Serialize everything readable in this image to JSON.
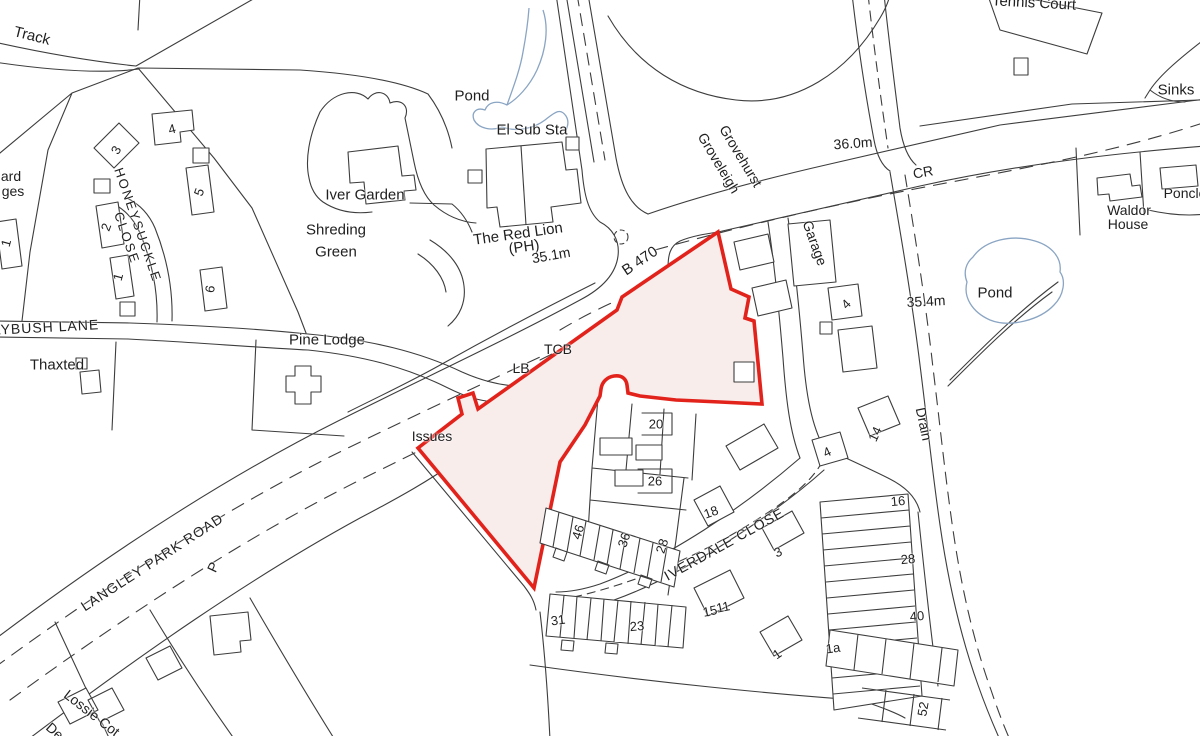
{
  "colors": {
    "background": "#ffffff",
    "linework": "#3d3d3d",
    "water": "#8aa5c3",
    "site_boundary": "#e2231c",
    "site_fill": "#f9edec",
    "label_text": "#1f1f1f"
  },
  "map": {
    "site": {
      "boundary_color_name": "red",
      "status_label": "Issues"
    },
    "road_names": [
      "LANGLEY PARK ROAD",
      "B 470",
      "LYBUSH LANE",
      "HONEYSUCKLE CLOSE",
      "IVERDALE CLOSE"
    ],
    "spot_heights": [
      "35.1m",
      "36.0m",
      "35.4m"
    ],
    "labels": [
      {
        "text": "Track",
        "x": 32,
        "y": 36,
        "r": 14,
        "s": 15
      },
      {
        "text": "4",
        "x": 172,
        "y": 129,
        "r": -15,
        "s": 13
      },
      {
        "text": "3",
        "x": 116,
        "y": 150,
        "r": -60,
        "s": 13
      },
      {
        "text": "5",
        "x": 199,
        "y": 192,
        "r": -70,
        "s": 13
      },
      {
        "text": "ard",
        "x": 11,
        "y": 176,
        "r": 0,
        "s": 14
      },
      {
        "text": "ges",
        "x": 13,
        "y": 191,
        "r": 0,
        "s": 14
      },
      {
        "text": "HONEYSUCKLE",
        "x": 138,
        "y": 225,
        "r": 71,
        "s": 13,
        "ls": 2
      },
      {
        "text": "CLOSE",
        "x": 127,
        "y": 238,
        "r": 71,
        "s": 13,
        "ls": 2
      },
      {
        "text": "2",
        "x": 106,
        "y": 227,
        "r": -70,
        "s": 13
      },
      {
        "text": "1",
        "x": 6,
        "y": 243,
        "r": -75,
        "s": 13
      },
      {
        "text": "1",
        "x": 118,
        "y": 277,
        "r": -75,
        "s": 13
      },
      {
        "text": "6",
        "x": 210,
        "y": 289,
        "r": -80,
        "s": 13
      },
      {
        "text": "LYBUSH LANE",
        "x": 46,
        "y": 327,
        "r": -3,
        "s": 14,
        "ls": 1
      },
      {
        "text": "Thaxted",
        "x": 57,
        "y": 365,
        "r": 0,
        "s": 15
      },
      {
        "text": "Pine Lodge",
        "x": 327,
        "y": 340,
        "r": 0,
        "s": 15
      },
      {
        "text": "Pond",
        "x": 472,
        "y": 96,
        "r": 0,
        "s": 15
      },
      {
        "text": "El Sub Sta",
        "x": 532,
        "y": 130,
        "r": 0,
        "s": 15
      },
      {
        "text": "Iver Garden",
        "x": 365,
        "y": 195,
        "r": 0,
        "s": 15
      },
      {
        "text": "Shreding",
        "x": 336,
        "y": 230,
        "r": 0,
        "s": 15
      },
      {
        "text": "Green",
        "x": 336,
        "y": 252,
        "r": 0,
        "s": 15
      },
      {
        "text": "The Red Lion",
        "x": 518,
        "y": 234,
        "r": -8,
        "s": 15
      },
      {
        "text": "(PH)",
        "x": 524,
        "y": 247,
        "r": -8,
        "s": 15
      },
      {
        "text": "35.1m",
        "x": 551,
        "y": 255,
        "r": -10,
        "s": 14
      },
      {
        "text": "B 470",
        "x": 640,
        "y": 261,
        "r": -34,
        "s": 15
      },
      {
        "text": "Grovehurst",
        "x": 741,
        "y": 156,
        "r": 59,
        "s": 14
      },
      {
        "text": "Groveleigh",
        "x": 719,
        "y": 163,
        "r": 59,
        "s": 14
      },
      {
        "text": "36.0m",
        "x": 853,
        "y": 143,
        "r": -4,
        "s": 14
      },
      {
        "text": "CR",
        "x": 923,
        "y": 172,
        "r": -10,
        "s": 14
      },
      {
        "text": "Tennis Court",
        "x": 1034,
        "y": 3,
        "r": 3,
        "s": 15
      },
      {
        "text": "Sinks",
        "x": 1176,
        "y": 90,
        "r": 0,
        "s": 15
      },
      {
        "text": "Waldor",
        "x": 1129,
        "y": 210,
        "r": 0,
        "s": 14
      },
      {
        "text": "House",
        "x": 1128,
        "y": 224,
        "r": 0,
        "s": 14
      },
      {
        "text": "Ponclo",
        "x": 1185,
        "y": 193,
        "r": 0,
        "s": 14
      },
      {
        "text": "Pond",
        "x": 995,
        "y": 293,
        "r": 0,
        "s": 15
      },
      {
        "text": "35.4m",
        "x": 926,
        "y": 301,
        "r": -3,
        "s": 14
      },
      {
        "text": "Garage",
        "x": 815,
        "y": 243,
        "r": 70,
        "s": 14
      },
      {
        "text": "4",
        "x": 846,
        "y": 304,
        "r": -45,
        "s": 13
      },
      {
        "text": "Drain",
        "x": 924,
        "y": 424,
        "r": 78,
        "s": 14
      },
      {
        "text": "TCB",
        "x": 558,
        "y": 349,
        "r": 0,
        "s": 14
      },
      {
        "text": "LB",
        "x": 521,
        "y": 368,
        "r": 0,
        "s": 14
      },
      {
        "text": "Issues",
        "x": 432,
        "y": 436,
        "r": 0,
        "s": 14
      },
      {
        "text": "20",
        "x": 656,
        "y": 424,
        "r": 0,
        "s": 13
      },
      {
        "text": "26",
        "x": 655,
        "y": 481,
        "r": 0,
        "s": 13
      },
      {
        "text": "46",
        "x": 578,
        "y": 532,
        "r": -72,
        "s": 13
      },
      {
        "text": "36",
        "x": 624,
        "y": 540,
        "r": -72,
        "s": 13
      },
      {
        "text": "28",
        "x": 662,
        "y": 546,
        "r": -72,
        "s": 13
      },
      {
        "text": "18",
        "x": 711,
        "y": 512,
        "r": -20,
        "s": 13
      },
      {
        "text": "IVERDALE CLOSE",
        "x": 724,
        "y": 544,
        "r": -29,
        "s": 14,
        "ls": 1
      },
      {
        "text": "3",
        "x": 778,
        "y": 552,
        "r": -25,
        "s": 13
      },
      {
        "text": "15",
        "x": 710,
        "y": 611,
        "r": -12,
        "s": 13
      },
      {
        "text": "11",
        "x": 723,
        "y": 607,
        "r": -12,
        "s": 13
      },
      {
        "text": "31",
        "x": 558,
        "y": 620,
        "r": -8,
        "s": 13
      },
      {
        "text": "23",
        "x": 637,
        "y": 626,
        "r": -5,
        "s": 13
      },
      {
        "text": "1",
        "x": 777,
        "y": 654,
        "r": -35,
        "s": 13
      },
      {
        "text": "1a",
        "x": 833,
        "y": 648,
        "r": -8,
        "s": 13
      },
      {
        "text": "14",
        "x": 875,
        "y": 434,
        "r": -65,
        "s": 13
      },
      {
        "text": "4",
        "x": 827,
        "y": 452,
        "r": -25,
        "s": 13
      },
      {
        "text": "16",
        "x": 898,
        "y": 501,
        "r": -5,
        "s": 13
      },
      {
        "text": "28",
        "x": 908,
        "y": 559,
        "r": -5,
        "s": 13
      },
      {
        "text": "40",
        "x": 917,
        "y": 616,
        "r": -5,
        "s": 13
      },
      {
        "text": "52",
        "x": 923,
        "y": 709,
        "r": -80,
        "s": 13
      },
      {
        "text": "P",
        "x": 213,
        "y": 567,
        "r": -65,
        "s": 14
      },
      {
        "text": "LANGLEY PARK ROAD",
        "x": 152,
        "y": 562,
        "r": -33,
        "s": 14,
        "ls": 1
      },
      {
        "text": "Lossie Cot",
        "x": 92,
        "y": 713,
        "r": 38,
        "s": 14
      },
      {
        "text": "De",
        "x": 55,
        "y": 731,
        "r": 42,
        "s": 14
      }
    ]
  }
}
